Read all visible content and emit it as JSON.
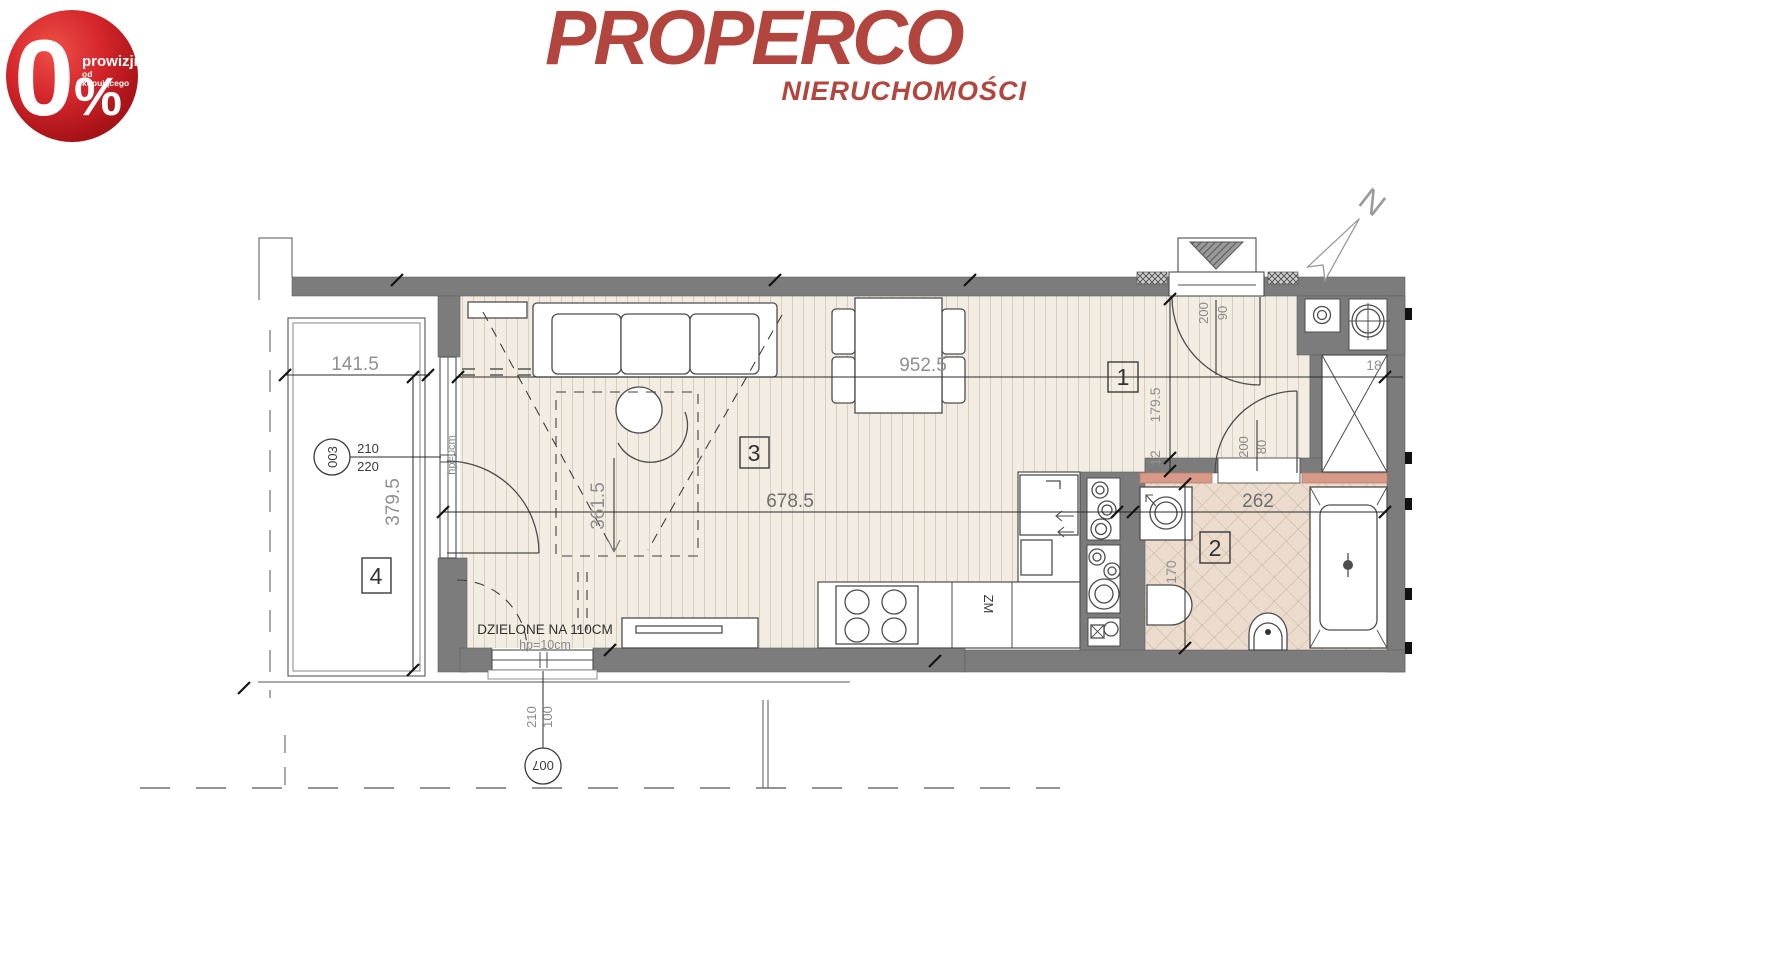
{
  "badge": {
    "digit": "0",
    "percent": "%",
    "line1": "prowizji",
    "line2": "od kupującego",
    "color": "#c0181d"
  },
  "logo": {
    "name": "PROPERCO",
    "tagline": "NIERUCHOMOŚCI",
    "color": "#b2463e"
  },
  "compass": {
    "north": "N"
  },
  "rooms": {
    "r1": "1",
    "r2": "2",
    "r3": "3",
    "r4": "4"
  },
  "dims": {
    "w141": "141.5",
    "h379": "379.5",
    "w952": "952.5",
    "w678": "678.5",
    "h361": "361.5",
    "h179": "179.5",
    "t12": "12",
    "w262": "262",
    "h170": "170",
    "w18": "18"
  },
  "openings": {
    "balcony_ref": "003",
    "balcony_w": "210",
    "balcony_h": "220",
    "entry_h": "200",
    "entry_w": "90",
    "bath_h": "200",
    "bath_w": "80",
    "win_ref": "007",
    "win_w": "100",
    "win_h": "210"
  },
  "notes": {
    "divided": "DZIELONE NA 110CM",
    "hp10": "hp=10cm",
    "hp0": "hp=0cm",
    "zm": "ZM"
  },
  "colors": {
    "wall": "#7c7c7c",
    "floor": "#f2ece2",
    "floor_stripe": "#d8cebf",
    "tile": "#ebdccd",
    "tile_line": "#c8b19e",
    "threshold": "#d69a86",
    "badge_red": "#c0181d",
    "logo_red": "#b2463e"
  }
}
